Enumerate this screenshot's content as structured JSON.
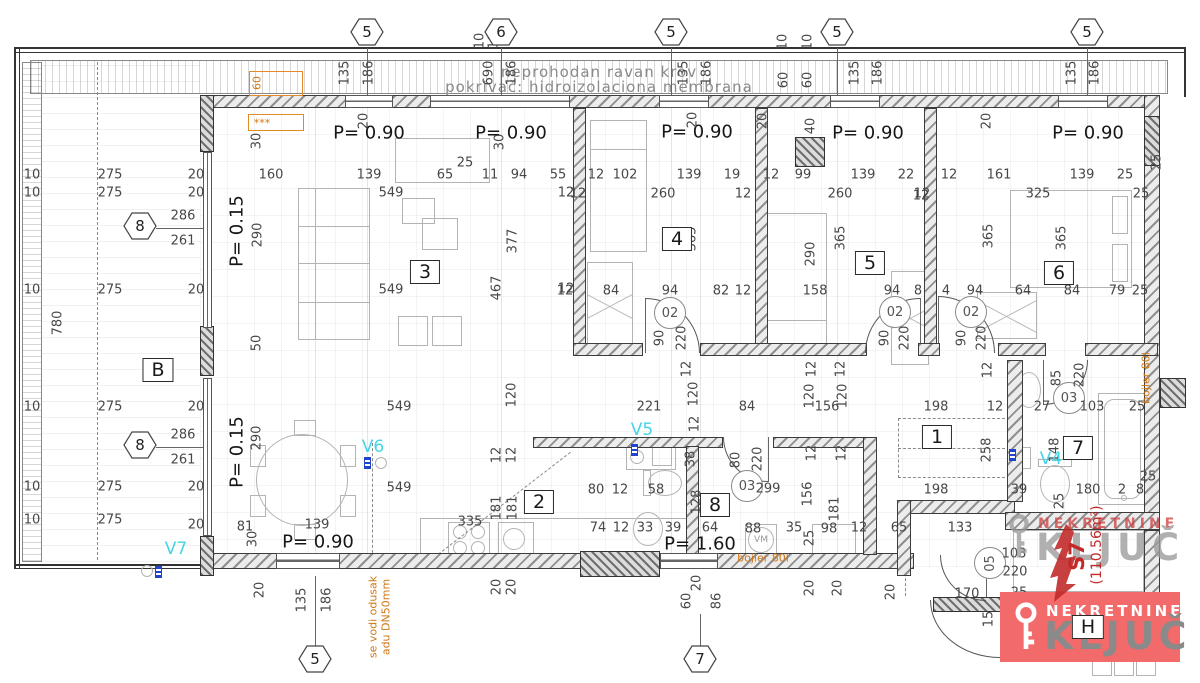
{
  "roof": {
    "line1": "neprohodan ravan krov",
    "line2": "pokrivač: hidroizolaciona membrana"
  },
  "apartment": {
    "unit": "S7",
    "area": "(110.56m²)"
  },
  "agency": {
    "top": "NEKRETNINE",
    "main": "KLJUČ"
  },
  "rooms": [
    [
      "B",
      158,
      370
    ],
    [
      "3",
      425,
      272
    ],
    [
      "4",
      677,
      239
    ],
    [
      "5",
      870,
      263
    ],
    [
      "6",
      1059,
      273
    ],
    [
      "1",
      937,
      437
    ],
    [
      "2",
      539,
      502
    ],
    [
      "8",
      715,
      505
    ],
    [
      "7",
      1078,
      448
    ],
    [
      "H",
      1088,
      627
    ]
  ],
  "p_labels": [
    [
      "P= 0.90",
      369,
      133,
      0
    ],
    [
      "P= 0.90",
      511,
      133,
      0
    ],
    [
      "P= 0.90",
      697,
      132,
      0
    ],
    [
      "P= 0.90",
      868,
      133,
      0
    ],
    [
      "P= 0.90",
      1088,
      133,
      0
    ],
    [
      "P= 0.15",
      237,
      231,
      1
    ],
    [
      "P= 0.15",
      237,
      452,
      1
    ],
    [
      "P= 0.90",
      318,
      542,
      0
    ],
    [
      "P= 1.60",
      700,
      544,
      0
    ]
  ],
  "grid_markers": {
    "top": [
      [
        "5",
        367,
        34
      ],
      [
        "6",
        501,
        34
      ],
      [
        "5",
        671,
        34
      ],
      [
        "5",
        837,
        34
      ],
      [
        "5",
        1087,
        34
      ]
    ],
    "left": [
      [
        "8",
        140,
        228
      ],
      [
        "8",
        140,
        447
      ]
    ],
    "bottom": [
      [
        "5",
        315,
        661
      ],
      [
        "7",
        700,
        661
      ]
    ]
  },
  "door_labels": [
    [
      "02",
      670,
      313,
      0
    ],
    [
      "02",
      895,
      312,
      0
    ],
    [
      "02",
      971,
      312,
      0
    ],
    [
      "03",
      747,
      486,
      0
    ],
    [
      "03",
      1069,
      398,
      0
    ],
    [
      "05",
      990,
      563,
      1
    ]
  ],
  "v_labels": [
    [
      "V7",
      176,
      549
    ],
    [
      "V6",
      373,
      447
    ],
    [
      "V5",
      642,
      430
    ],
    [
      "V4",
      1051,
      459
    ]
  ],
  "dims": [
    [
      "10",
      32,
      175,
      0
    ],
    [
      "10",
      32,
      193,
      0
    ],
    [
      "10",
      32,
      290,
      0
    ],
    [
      "10",
      32,
      407,
      0
    ],
    [
      "10",
      32,
      487,
      0
    ],
    [
      "10",
      32,
      520,
      0
    ],
    [
      "275",
      110,
      175,
      0
    ],
    [
      "275",
      110,
      193,
      0
    ],
    [
      "275",
      110,
      290,
      0
    ],
    [
      "275",
      110,
      407,
      0
    ],
    [
      "275",
      110,
      487,
      0
    ],
    [
      "275",
      110,
      520,
      0
    ],
    [
      "20",
      196,
      175,
      0
    ],
    [
      "20",
      196,
      193,
      0
    ],
    [
      "20",
      196,
      290,
      0
    ],
    [
      "20",
      196,
      407,
      0
    ],
    [
      "20",
      196,
      487,
      0
    ],
    [
      "20",
      196,
      525,
      0
    ],
    [
      "780",
      58,
      323,
      1
    ],
    [
      "286",
      183,
      216,
      0
    ],
    [
      "261",
      183,
      241,
      0
    ],
    [
      "286",
      183,
      435,
      0
    ],
    [
      "261",
      183,
      460,
      0
    ],
    [
      "135",
      345,
      73,
      1
    ],
    [
      "186",
      369,
      73,
      1
    ],
    [
      "690",
      489,
      73,
      1
    ],
    [
      "186",
      512,
      73,
      1
    ],
    [
      "135",
      684,
      73,
      1
    ],
    [
      "186",
      707,
      73,
      1
    ],
    [
      "135",
      855,
      73,
      1
    ],
    [
      "186",
      878,
      73,
      1
    ],
    [
      "135",
      1072,
      73,
      1
    ],
    [
      "186",
      1095,
      73,
      1
    ],
    [
      "10",
      480,
      41,
      1
    ],
    [
      "10",
      494,
      41,
      1
    ],
    [
      "10",
      783,
      42,
      1
    ],
    [
      "10",
      808,
      42,
      1
    ],
    [
      "60",
      784,
      80,
      1
    ],
    [
      "60",
      808,
      80,
      1
    ],
    [
      "30",
      257,
      141,
      1
    ],
    [
      "30",
      500,
      142,
      1
    ],
    [
      "20",
      364,
      121,
      1
    ],
    [
      "20",
      693,
      120,
      1
    ],
    [
      "20",
      763,
      121,
      1
    ],
    [
      "40",
      811,
      126,
      1
    ],
    [
      "20",
      987,
      121,
      1
    ],
    [
      "160",
      271,
      175,
      0
    ],
    [
      "139",
      369,
      175,
      0
    ],
    [
      "65",
      445,
      175,
      0
    ],
    [
      "25",
      465,
      163,
      0
    ],
    [
      "11",
      490,
      175,
      0
    ],
    [
      "94",
      519,
      175,
      0
    ],
    [
      "55",
      558,
      175,
      0
    ],
    [
      "549",
      391,
      193,
      0
    ],
    [
      "12",
      566,
      193,
      0
    ],
    [
      "290",
      258,
      235,
      1
    ],
    [
      "377",
      513,
      241,
      1
    ],
    [
      "467",
      497,
      288,
      1
    ],
    [
      "549",
      391,
      290,
      0
    ],
    [
      "12",
      566,
      289,
      0
    ],
    [
      "549",
      399,
      407,
      0
    ],
    [
      "290",
      257,
      438,
      1
    ],
    [
      "549",
      399,
      488,
      0
    ],
    [
      "81",
      245,
      527,
      0
    ],
    [
      "30",
      253,
      539,
      1
    ],
    [
      "139",
      317,
      525,
      0
    ],
    [
      "50",
      257,
      343,
      1
    ],
    [
      "120",
      512,
      395,
      1
    ],
    [
      "221",
      649,
      407,
      0
    ],
    [
      "12",
      687,
      369,
      1
    ],
    [
      "120",
      694,
      394,
      1
    ],
    [
      "12",
      695,
      424,
      1
    ],
    [
      "84",
      747,
      407,
      0
    ],
    [
      "12",
      812,
      369,
      1
    ],
    [
      "12",
      841,
      369,
      1
    ],
    [
      "120",
      810,
      396,
      1
    ],
    [
      "156",
      827,
      407,
      0
    ],
    [
      "120",
      843,
      396,
      1
    ],
    [
      "198",
      936,
      407,
      0
    ],
    [
      "12",
      995,
      407,
      0
    ],
    [
      "27",
      1042,
      407,
      0
    ],
    [
      "103",
      1092,
      407,
      0
    ],
    [
      "25",
      1137,
      407,
      0
    ],
    [
      "12",
      988,
      370,
      1
    ],
    [
      "12",
      497,
      455,
      1
    ],
    [
      "12",
      512,
      455,
      1
    ],
    [
      "181",
      497,
      508,
      1
    ],
    [
      "181",
      513,
      508,
      1
    ],
    [
      "335",
      470,
      522,
      0
    ],
    [
      "20",
      497,
      587,
      1
    ],
    [
      "20",
      512,
      587,
      1
    ],
    [
      "20",
      260,
      590,
      1
    ],
    [
      "80",
      596,
      490,
      0
    ],
    [
      "12",
      620,
      490,
      0
    ],
    [
      "58",
      656,
      490,
      0
    ],
    [
      "38",
      691,
      459,
      1
    ],
    [
      "74",
      598,
      528,
      0
    ],
    [
      "12",
      621,
      528,
      0
    ],
    [
      "33",
      645,
      528,
      0
    ],
    [
      "39",
      673,
      528,
      0
    ],
    [
      "64",
      710,
      528,
      0
    ],
    [
      "88",
      753,
      529,
      0
    ],
    [
      "35",
      794,
      528,
      0
    ],
    [
      "98",
      829,
      529,
      0
    ],
    [
      "12",
      859,
      528,
      0
    ],
    [
      "25",
      810,
      538,
      1
    ],
    [
      "156",
      808,
      494,
      1
    ],
    [
      "181",
      835,
      509,
      1
    ],
    [
      "12",
      812,
      453,
      1
    ],
    [
      "12",
      842,
      453,
      1
    ],
    [
      "299",
      768,
      489,
      0
    ],
    [
      "80",
      736,
      460,
      1
    ],
    [
      "220",
      758,
      459,
      1
    ],
    [
      "128",
      697,
      502,
      1
    ],
    [
      "20",
      810,
      588,
      1
    ],
    [
      "20",
      838,
      588,
      1
    ],
    [
      "20",
      891,
      592,
      1
    ],
    [
      "12",
      596,
      175,
      0
    ],
    [
      "102",
      625,
      175,
      0
    ],
    [
      "139",
      689,
      175,
      0
    ],
    [
      "19",
      732,
      175,
      0
    ],
    [
      "12",
      578,
      194,
      0
    ],
    [
      "260",
      663,
      194,
      0
    ],
    [
      "12",
      743,
      194,
      0
    ],
    [
      "365",
      692,
      239,
      1
    ],
    [
      "84",
      611,
      291,
      0
    ],
    [
      "94",
      670,
      291,
      0
    ],
    [
      "82",
      721,
      291,
      0
    ],
    [
      "12",
      743,
      291,
      0
    ],
    [
      "12",
      565,
      291,
      0
    ],
    [
      "90",
      660,
      338,
      1
    ],
    [
      "220",
      682,
      338,
      1
    ],
    [
      "12",
      771,
      175,
      0
    ],
    [
      "99",
      803,
      175,
      0
    ],
    [
      "139",
      863,
      175,
      0
    ],
    [
      "22",
      906,
      175,
      0
    ],
    [
      "260",
      840,
      194,
      0
    ],
    [
      "12",
      921,
      196,
      0
    ],
    [
      "290",
      811,
      254,
      1
    ],
    [
      "365",
      841,
      238,
      1
    ],
    [
      "158",
      815,
      291,
      0
    ],
    [
      "94",
      892,
      291,
      0
    ],
    [
      "8",
      918,
      291,
      0
    ],
    [
      "4",
      946,
      291,
      0
    ],
    [
      "90",
      885,
      338,
      1
    ],
    [
      "220",
      905,
      338,
      1
    ],
    [
      "90",
      962,
      338,
      1
    ],
    [
      "220",
      982,
      338,
      1
    ],
    [
      "12",
      949,
      175,
      0
    ],
    [
      "161",
      999,
      175,
      0
    ],
    [
      "139",
      1082,
      175,
      0
    ],
    [
      "25",
      1125,
      175,
      0
    ],
    [
      "12",
      922,
      194,
      0
    ],
    [
      "325",
      1038,
      194,
      0
    ],
    [
      "25",
      1141,
      194,
      0
    ],
    [
      "365",
      989,
      236,
      1
    ],
    [
      "365",
      1062,
      238,
      1
    ],
    [
      "64",
      1023,
      291,
      0
    ],
    [
      "84",
      1072,
      291,
      0
    ],
    [
      "79",
      1117,
      291,
      0
    ],
    [
      "25",
      1140,
      291,
      0
    ],
    [
      "94",
      975,
      291,
      0
    ],
    [
      "25",
      1157,
      162,
      1
    ],
    [
      "85",
      1057,
      378,
      1
    ],
    [
      "220",
      1080,
      375,
      1
    ],
    [
      "258",
      987,
      450,
      1
    ],
    [
      "148",
      1055,
      450,
      1
    ],
    [
      "39",
      1019,
      490,
      0
    ],
    [
      "25",
      1060,
      501,
      1
    ],
    [
      "180",
      1088,
      490,
      0
    ],
    [
      "2",
      1122,
      490,
      0
    ],
    [
      "8",
      1140,
      490,
      0
    ],
    [
      "25",
      1148,
      477,
      0
    ],
    [
      "198",
      936,
      490,
      0
    ],
    [
      "65",
      899,
      528,
      0
    ],
    [
      "133",
      960,
      528,
      0
    ],
    [
      "170",
      967,
      594,
      0
    ],
    [
      "15",
      989,
      619,
      1
    ],
    [
      "25",
      1019,
      593,
      0
    ],
    [
      "220",
      1015,
      572,
      0
    ],
    [
      "103",
      1014,
      554,
      0
    ],
    [
      "21",
      1055,
      625,
      1
    ],
    [
      "135",
      302,
      600,
      1
    ],
    [
      "186",
      327,
      600,
      1
    ],
    [
      "60",
      687,
      601,
      1
    ],
    [
      "86",
      717,
      601,
      1
    ],
    [
      "20",
      697,
      583,
      1
    ]
  ],
  "notes": [
    [
      "***",
      262,
      123,
      0,
      "o"
    ],
    [
      "60",
      257,
      83,
      1,
      "o"
    ],
    [
      "bojler 80l",
      763,
      558,
      0,
      "o"
    ],
    [
      "bojler 80l",
      1146,
      378,
      1,
      "o"
    ],
    [
      "se vodi odusak",
      373,
      617,
      1,
      "o"
    ],
    [
      "adu DN50mm",
      386,
      617,
      1,
      "o"
    ],
    [
      "VM",
      761,
      540,
      0,
      "g"
    ]
  ],
  "colors": {
    "accent_red": "#c22a2a",
    "logo_bg": "#f26a6a",
    "cyan": "#45d5e6",
    "orange": "#d07818"
  }
}
